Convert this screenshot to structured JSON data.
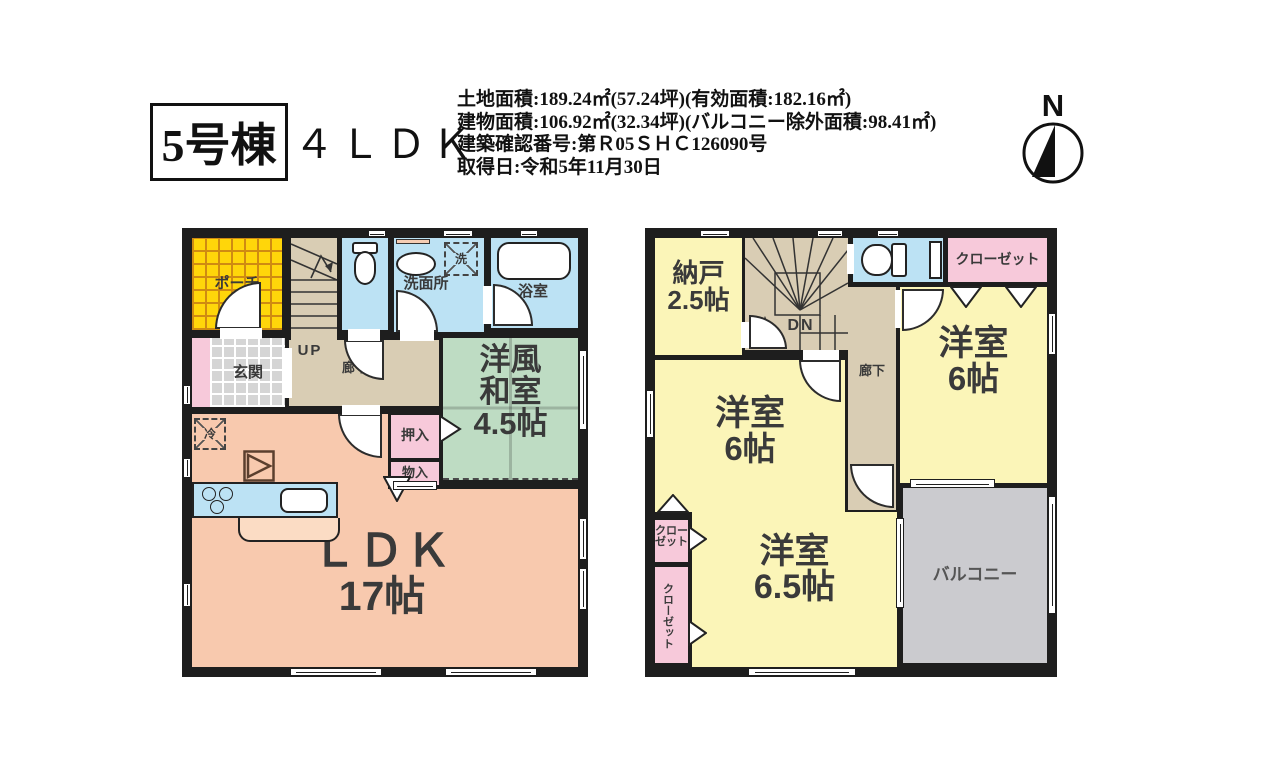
{
  "header": {
    "unit_label": "5号棟",
    "layout_label": "４ＬＤＫ",
    "info_lines": [
      "土地面積:189.24㎡(57.24坪)(有効面積:182.16㎡)",
      "建物面積:106.92㎡(32.34坪)(バルコニー除外面積:98.41㎡)",
      "建築確認番号:第Ｒ05ＳＨＣ126090号",
      "取得日:令和5年11月30日"
    ],
    "compass_label": "N"
  },
  "f1": {
    "porch": "ポーチ",
    "up": "UP",
    "entrance": "玄関",
    "corridor": "廊下",
    "washroom": "洗面所",
    "washer": "洗",
    "bathroom": "浴室",
    "washitsu": [
      "洋風",
      "和室",
      "4.5帖"
    ],
    "oshiire": "押入",
    "monoire": "物入",
    "fridge": "冷",
    "ldk": [
      "ＬＤＫ",
      "17帖"
    ]
  },
  "f2": {
    "nando": [
      "納戸",
      "2.5帖"
    ],
    "dn": "DN",
    "corridor": "廊下",
    "closet_top_right": "クローゼット",
    "yoshitsu_right": [
      "洋室",
      "6帖"
    ],
    "yoshitsu_left": [
      "洋室",
      "6帖"
    ],
    "closet_small": [
      "クロー",
      "ゼット"
    ],
    "closet_tall": "クローゼット",
    "yoshitsu_65": [
      "洋室",
      "6.5帖"
    ],
    "balcony": "バルコニー"
  },
  "colors": {
    "wall": "#1e1e1e",
    "porch_yellow": "#ffd60a",
    "corridor_tan": "#d9cdb4",
    "water_blue": "#bce2f4",
    "washitsu_green": "#bedcc3",
    "ldk_salmon": "#f8c9ae",
    "closet_pink": "#f7c9da",
    "room_yellow": "#fbf5b8",
    "balcony_gray": "#cbcbcf"
  }
}
